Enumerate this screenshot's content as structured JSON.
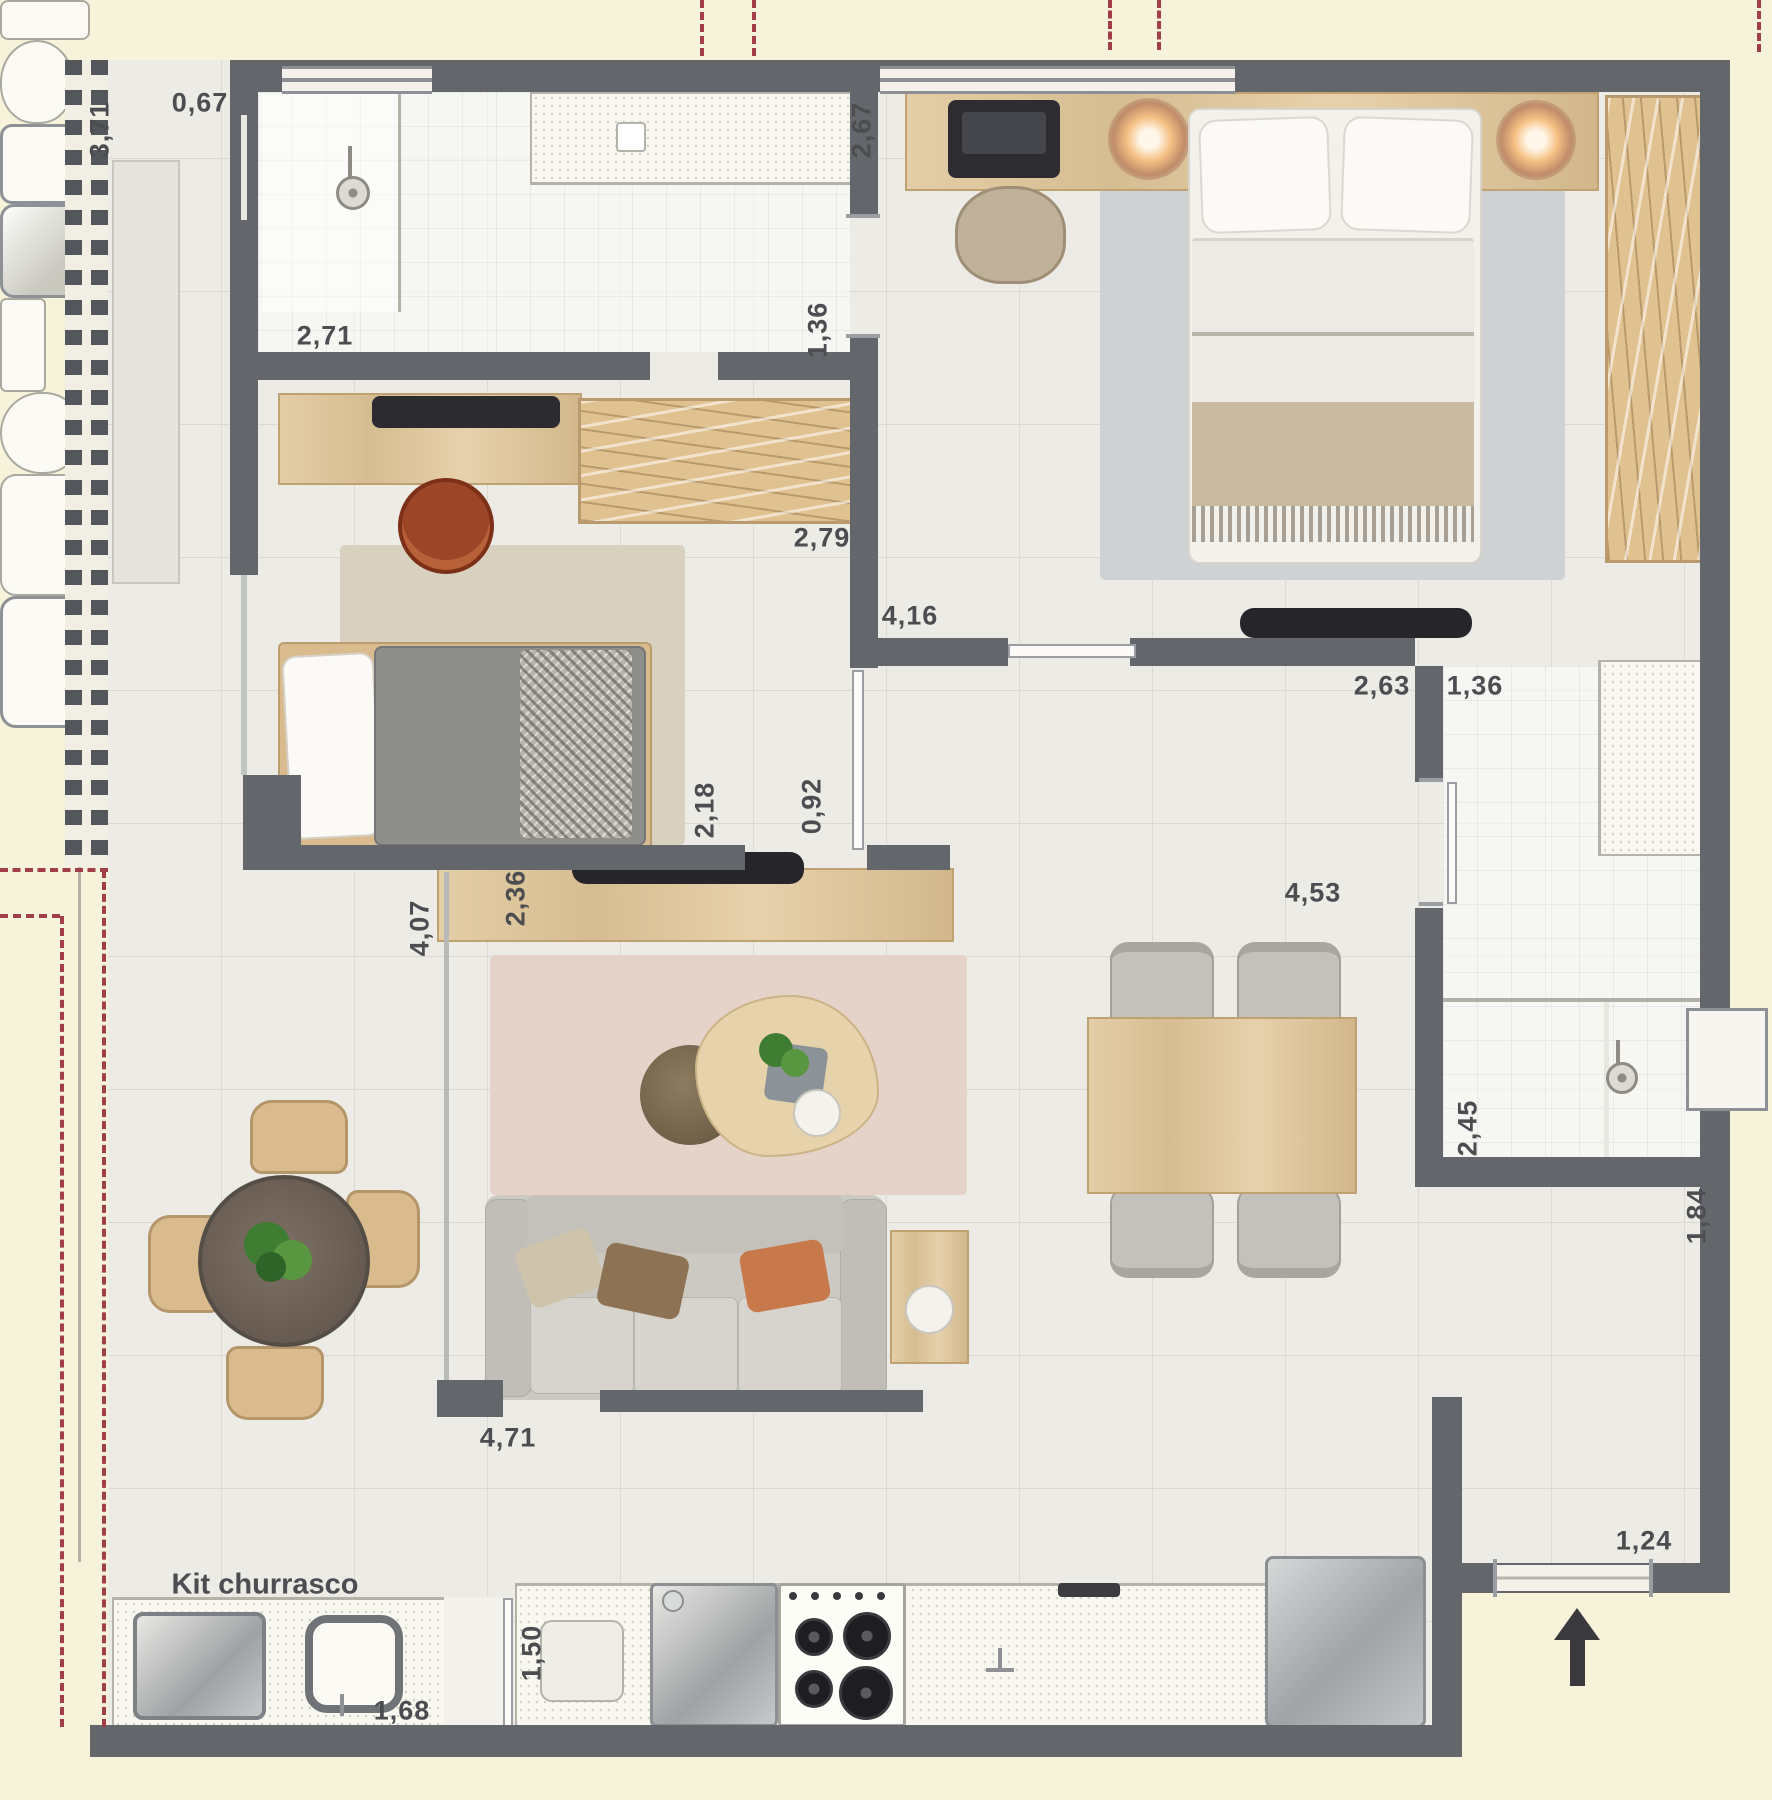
{
  "annotations": {
    "kit_churrasco": "Kit churrasco"
  },
  "dims": [
    {
      "text": "3,71"
    },
    {
      "text": "0,67"
    },
    {
      "text": "2,71"
    },
    {
      "text": "2,67"
    },
    {
      "text": "1,36"
    },
    {
      "text": "2,79"
    },
    {
      "text": "4,16"
    },
    {
      "text": "2,63"
    },
    {
      "text": "1,36"
    },
    {
      "text": "2,18"
    },
    {
      "text": "0,92"
    },
    {
      "text": "2,36"
    },
    {
      "text": "4,07"
    },
    {
      "text": "4,53"
    },
    {
      "text": "2,45"
    },
    {
      "text": "1,84"
    },
    {
      "text": "1,24"
    },
    {
      "text": "4,71"
    },
    {
      "text": "1,50"
    },
    {
      "text": "1,68"
    }
  ],
  "colors": {
    "wall": "#63666b",
    "projection_dash": "#a13e47",
    "wood": "#dcc199",
    "floor": "#ecebe5",
    "background": "#f6f3da"
  }
}
